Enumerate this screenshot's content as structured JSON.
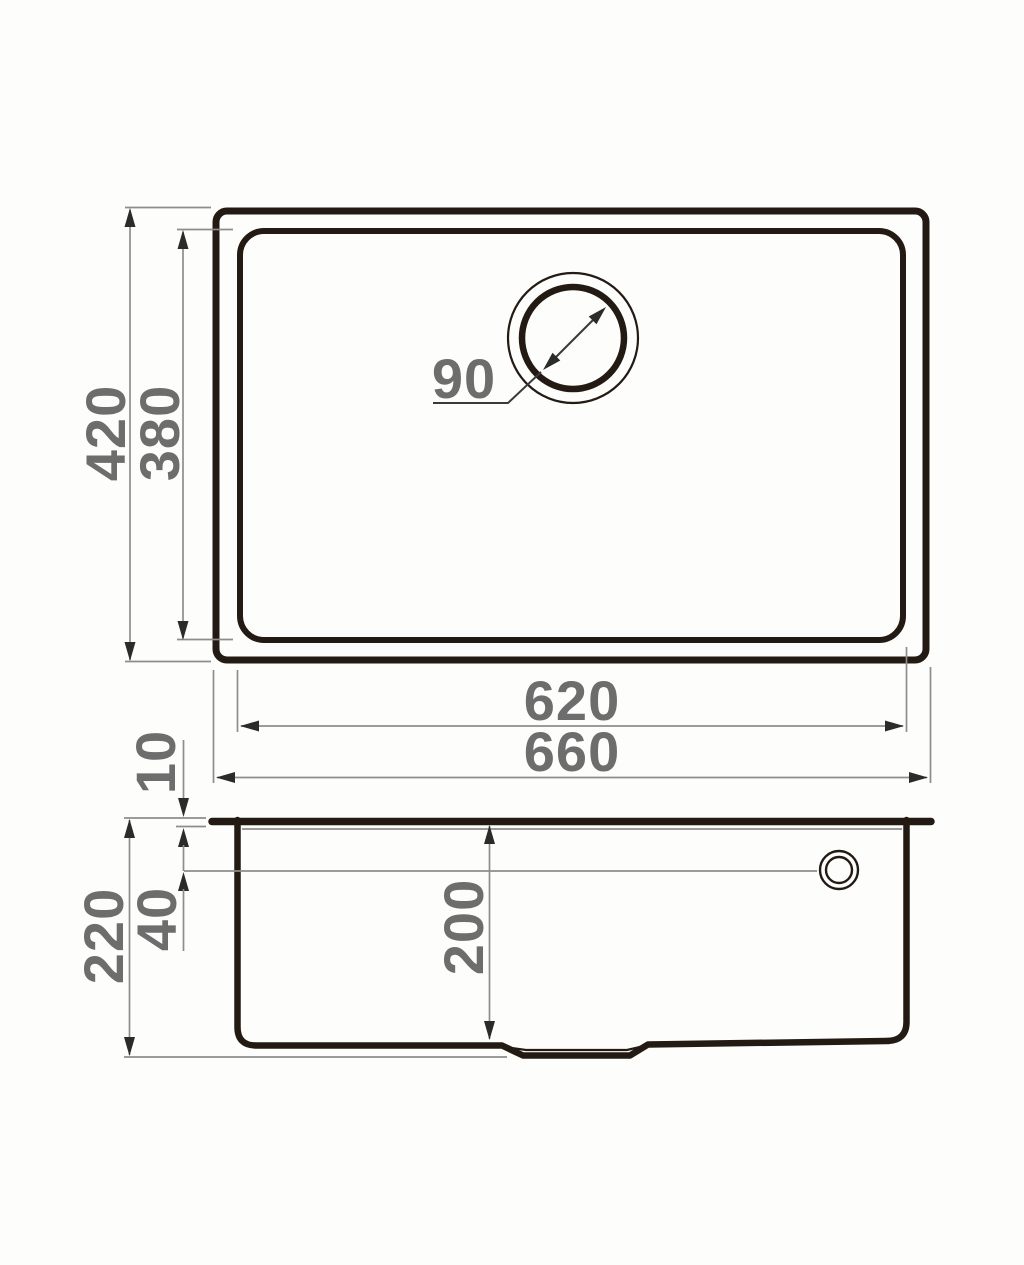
{
  "top_view": {
    "overall_width": "660",
    "inner_width": "620",
    "overall_depth": "420",
    "inner_depth": "380",
    "drain_diameter": "90"
  },
  "side_view": {
    "overall_height": "220",
    "bowl_depth": "200",
    "rim_height": "10",
    "overflow_offset": "40"
  },
  "colors": {
    "outline": "#231a13",
    "dimension_line": "#8d8d8d",
    "arrow": "#2b2b2b",
    "label_text": "#6d6d6d",
    "background": "#fdfdfc"
  }
}
